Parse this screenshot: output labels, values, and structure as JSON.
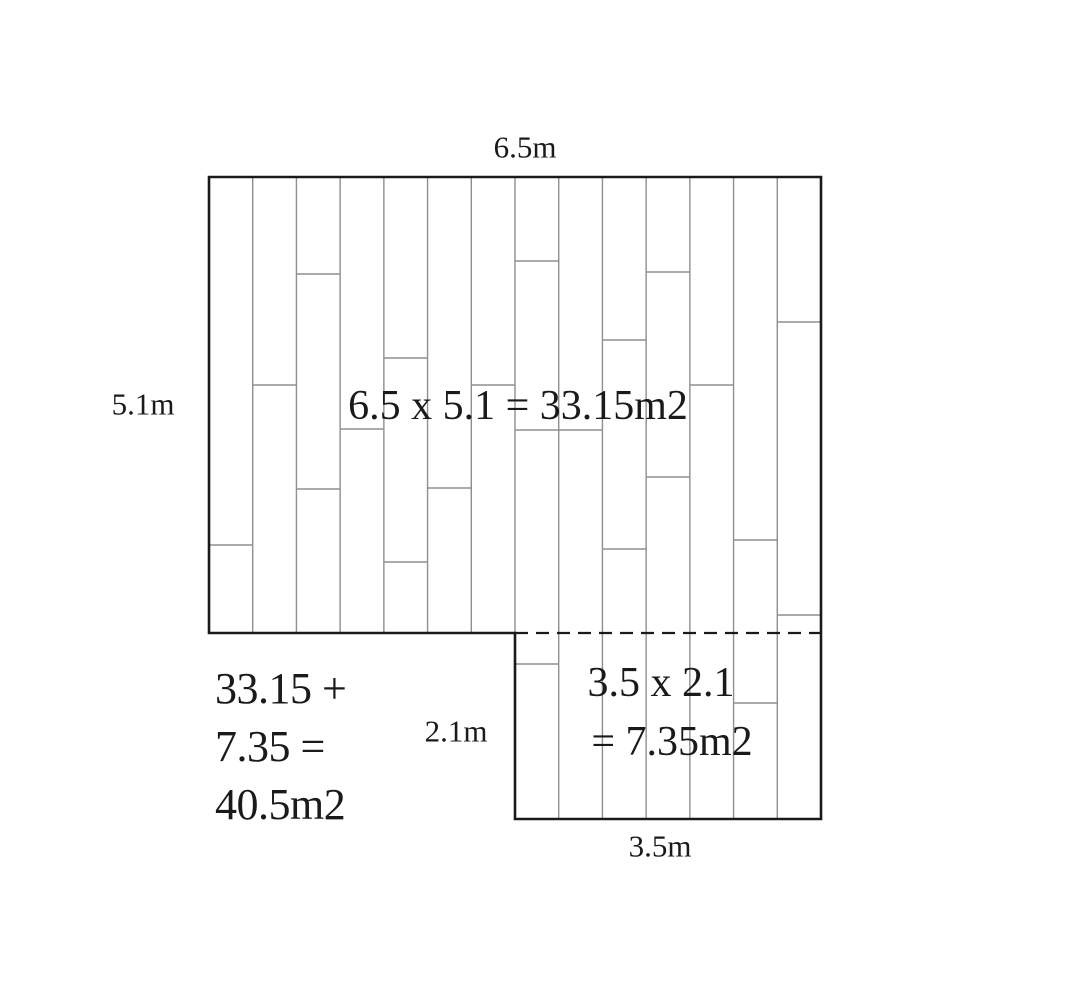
{
  "colors": {
    "background": "#ffffff",
    "outline": "#1a1a1a",
    "plank_line": "#8f8f8f",
    "text": "#1a1a1a"
  },
  "labels": {
    "top_width": "6.5m",
    "left_height": "5.1m",
    "annex_height": "2.1m",
    "annex_width": "3.5m",
    "main_area_formula": "6.5 x 5.1 = 33.15m2",
    "annex_area_line1": "3.5 x 2.1",
    "annex_area_line2": "= 7.35m2",
    "total_line1": "33.15 +",
    "total_line2": "7.35 =",
    "total_line3": "40.5m2"
  },
  "floor": {
    "left": 209,
    "top": 177,
    "right": 821,
    "main_bottom": 633,
    "bottom": 819,
    "step_x": 515,
    "plank_columns": 14,
    "outline_width": 2.6,
    "plank_line_width": 1.4,
    "dash_pattern": "13 8",
    "seams": [
      [
        545
      ],
      [
        385
      ],
      [
        274,
        489
      ],
      [
        429
      ],
      [
        358,
        562
      ],
      [
        488
      ],
      [
        385
      ],
      [
        261,
        430,
        664
      ],
      [
        430
      ],
      [
        340,
        549
      ],
      [
        272,
        477
      ],
      [
        385
      ],
      [
        540,
        703
      ],
      [
        322,
        615
      ]
    ]
  },
  "label_positions": {
    "top_width": {
      "x": 525,
      "y": 147
    },
    "left_height": {
      "x": 143,
      "y": 404
    },
    "annex_height": {
      "x": 456,
      "y": 731
    },
    "annex_width": {
      "x": 660,
      "y": 846
    },
    "main_area_formula": {
      "x": 518,
      "y": 406
    },
    "annex_area_line1": {
      "x": 661,
      "y": 683
    },
    "annex_area_line2": {
      "x": 672,
      "y": 742
    }
  }
}
